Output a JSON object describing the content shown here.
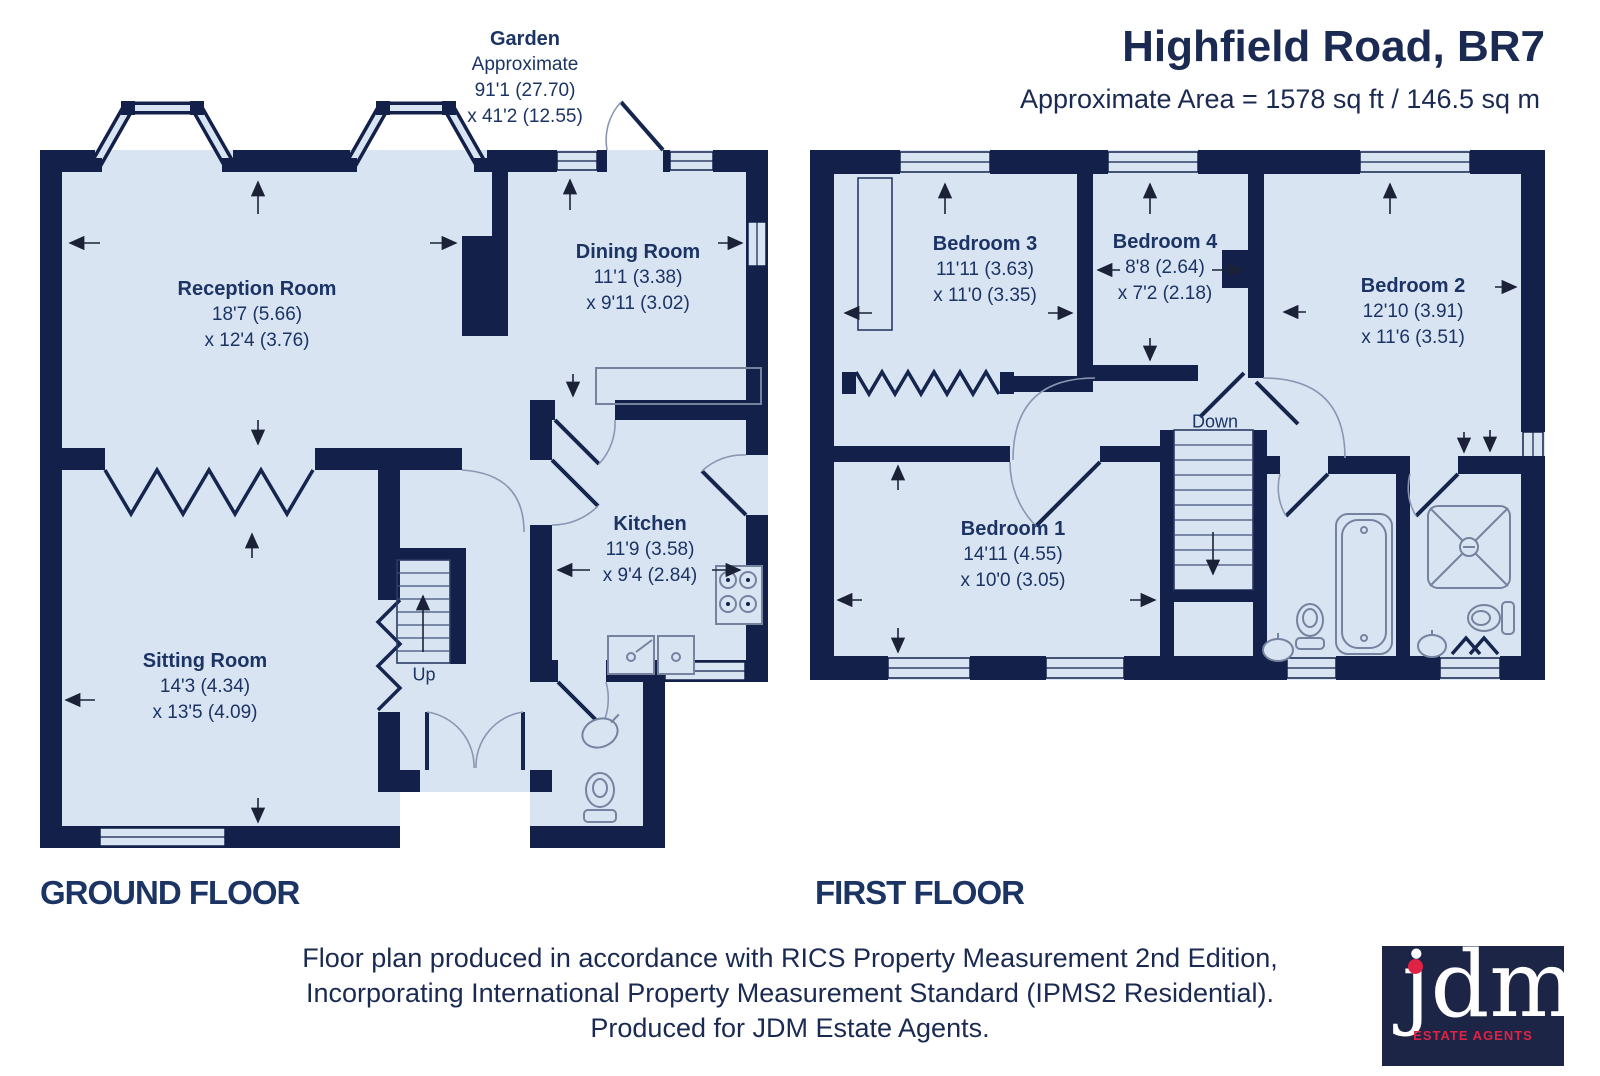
{
  "header": {
    "title": "Highfield Road, BR7",
    "area_line": "Approximate Area = 1578 sq ft / 146.5 sq m"
  },
  "garden_label": {
    "title": "Garden",
    "line2": "Approximate",
    "line3": "91'1 (27.70)",
    "line4": "x 41'2 (12.55)"
  },
  "floors": {
    "ground": {
      "label": "GROUND FLOOR",
      "stairs": "Up",
      "rooms": {
        "reception": {
          "name": "Reception Room",
          "d1": "18'7 (5.66)",
          "d2": "x 12'4 (3.76)"
        },
        "dining": {
          "name": "Dining Room",
          "d1": "11'1 (3.38)",
          "d2": "x 9'11 (3.02)"
        },
        "kitchen": {
          "name": "Kitchen",
          "d1": "11'9 (3.58)",
          "d2": "x 9'4 (2.84)"
        },
        "sitting": {
          "name": "Sitting Room",
          "d1": "14'3 (4.34)",
          "d2": "x 13'5 (4.09)"
        }
      }
    },
    "first": {
      "label": "FIRST FLOOR",
      "stairs": "Down",
      "rooms": {
        "bedroom1": {
          "name": "Bedroom 1",
          "d1": "14'11 (4.55)",
          "d2": "x 10'0 (3.05)"
        },
        "bedroom2": {
          "name": "Bedroom 2",
          "d1": "12'10 (3.91)",
          "d2": "x 11'6 (3.51)"
        },
        "bedroom3": {
          "name": "Bedroom 3",
          "d1": "11'11 (3.63)",
          "d2": "x 11'0 (3.35)"
        },
        "bedroom4": {
          "name": "Bedroom 4",
          "d1": "8'8 (2.64)",
          "d2": "x 7'2 (2.18)"
        }
      }
    }
  },
  "footer": {
    "line1": "Floor plan produced in accordance with RICS Property Measurement 2nd Edition,",
    "line2": "Incorporating International Property Measurement Standard (IPMS2 Residential).",
    "line3": "Produced for JDM Estate Agents."
  },
  "logo": {
    "name": "jdm",
    "tagline": "ESTATE AGENTS"
  },
  "colors": {
    "wall": "#13214a",
    "room_fill": "#d9e4f3",
    "text": "#1c3464",
    "logo_bg": "#1d2547",
    "logo_red": "#e02245"
  }
}
